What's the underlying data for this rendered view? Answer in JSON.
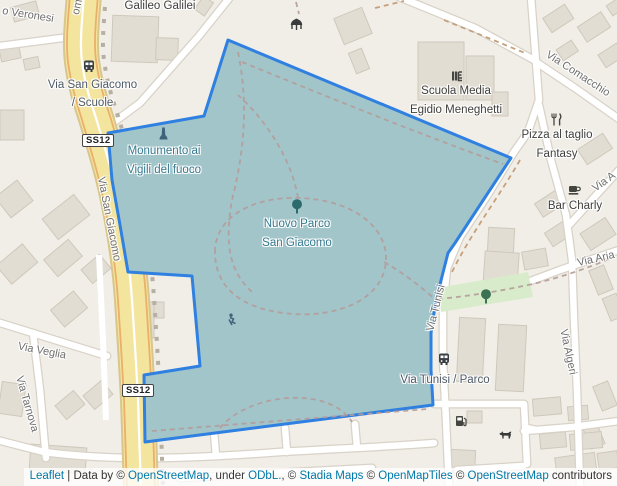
{
  "streets": {
    "veronesi": "o Veronesi",
    "san_giacomo_cut": "omo",
    "san_giacomo": "Via San Giacomo",
    "veglia": "Via Veglia",
    "tarnova": "Via Tarnova",
    "comacchio": "Via Comacchio",
    "tunisi": "Via Tunisi",
    "algeri": "Via Algeri",
    "aria": "Via Aria",
    "a_cut": "Via A",
    "ss12": "SS12"
  },
  "pois": {
    "galileo": "Galileo Galilei",
    "scuola_line1": "Scuola Media",
    "scuola_line2": "Egidio Meneghetti",
    "pizza_line1": "Pizza al taglio",
    "pizza_line2": "Fantasy",
    "bar": "Bar Charly",
    "monumento_line1": "Monumento ai",
    "monumento_line2": "Vigili del fuoco",
    "park_line1": "Nuovo Parco",
    "park_line2": "San Giacomo"
  },
  "transit": {
    "stop1_line1": "Via San Giacomo",
    "stop1_line2": "/ Scuole",
    "stop2": "Via Tunisi / Parco"
  },
  "attribution": {
    "leaflet": "Leaflet",
    "sep1": " | Data by © ",
    "osm1": "OpenStreetMap",
    "sep2": ", under ",
    "odbl": "ODbL.",
    "sep3": ", © ",
    "stadia": "Stadia Maps",
    "sep4": " © ",
    "openmaptiles": "OpenMapTiles",
    "sep5": " © ",
    "osm2": "OpenStreetMap",
    "sep6": " contributors"
  },
  "icons": [
    "bus-icon",
    "playground-icon",
    "monument-icon",
    "tree-icon",
    "school-icon",
    "restaurant-icon",
    "cafe-icon",
    "fuel-icon",
    "dog-park-icon"
  ],
  "colors": {
    "land": "#f1eee8",
    "building": "#e2ddd3",
    "park_fill": "#a2c5ca",
    "park_stroke": "#2f80e0",
    "primary_road": "#f4e59e",
    "green_area": "#d8eccb",
    "link_blue": "#0078a8",
    "park_label": "#35798f"
  }
}
